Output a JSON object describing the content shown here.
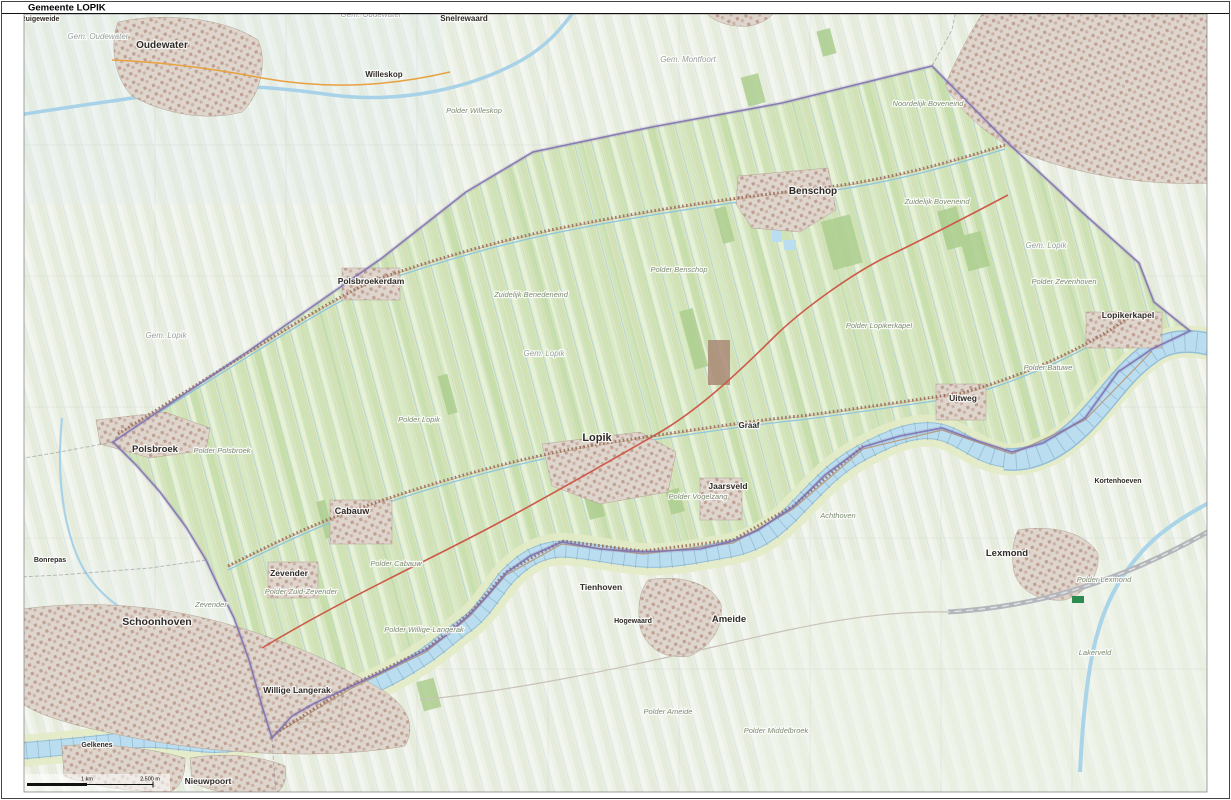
{
  "title": "Gemeente LOPIK",
  "scalebar": {
    "label_km": "1 km",
    "label_m": "2.500 m"
  },
  "colors": {
    "municipality_fill": "#dce9c8",
    "municipality_boundary": "#7b6cae",
    "water": "#badef0",
    "water_edge": "#94bed8",
    "urban": "#c9aca0",
    "main_road": "#cd5b4a",
    "outside_fill": "#eef1e7",
    "motorway": "#b3b6bb"
  },
  "map": {
    "labels": [
      {
        "id": "oudewater",
        "text": "Oudewater",
        "x": 162,
        "y": 48,
        "type": "town",
        "size": 10
      },
      {
        "id": "schoonhoven",
        "text": "Schoonhoven",
        "x": 157,
        "y": 625,
        "type": "town",
        "size": 10.5
      },
      {
        "id": "benschop",
        "text": "Benschop",
        "x": 813,
        "y": 194,
        "type": "town",
        "size": 10
      },
      {
        "id": "lopik",
        "text": "Lopik",
        "x": 597,
        "y": 441,
        "type": "town",
        "size": 11
      },
      {
        "id": "polsbroek",
        "text": "Polsbroek",
        "x": 155,
        "y": 452,
        "type": "town",
        "size": 9.5
      },
      {
        "id": "polsbroekerdam",
        "text": "Polsbroekerdam",
        "x": 371,
        "y": 284,
        "type": "town",
        "size": 8.5
      },
      {
        "id": "cabauw",
        "text": "Cabauw",
        "x": 352,
        "y": 514,
        "type": "town",
        "size": 9
      },
      {
        "id": "zevender",
        "text": "Zevender",
        "x": 289,
        "y": 576,
        "type": "town",
        "size": 8.5
      },
      {
        "id": "willige-langerak",
        "text": "Willige Langerak",
        "x": 297,
        "y": 693,
        "type": "town",
        "size": 8.5
      },
      {
        "id": "jaarsveld",
        "text": "Jaarsveld",
        "x": 728,
        "y": 489,
        "type": "town",
        "size": 8.5
      },
      {
        "id": "uitweg",
        "text": "Uitweg",
        "x": 963,
        "y": 401,
        "type": "town",
        "size": 8.5
      },
      {
        "id": "lopikerkapel",
        "text": "Lopikerkapel",
        "x": 1128,
        "y": 318,
        "type": "town",
        "size": 8.5
      },
      {
        "id": "graaf",
        "text": "Graaf",
        "x": 749,
        "y": 428,
        "type": "town",
        "size": 8
      },
      {
        "id": "ameide",
        "text": "Ameide",
        "x": 729,
        "y": 622,
        "type": "town",
        "size": 9.5
      },
      {
        "id": "tienhoven",
        "text": "Tienhoven",
        "x": 601,
        "y": 590,
        "type": "town",
        "size": 8.5
      },
      {
        "id": "lexmond",
        "text": "Lexmond",
        "x": 1007,
        "y": 556,
        "type": "town",
        "size": 9.5
      },
      {
        "id": "nieuwpoort",
        "text": "Nieuwpoort",
        "x": 208,
        "y": 784,
        "type": "town",
        "size": 8.5
      },
      {
        "id": "snelrewaard",
        "text": "Snelrewaard",
        "x": 464,
        "y": 21,
        "type": "town",
        "size": 8
      },
      {
        "id": "willeskop",
        "text": "Willeskop",
        "x": 384,
        "y": 77,
        "type": "town",
        "size": 8
      },
      {
        "id": "bonrepas",
        "text": "Bonrepas",
        "x": 50,
        "y": 562,
        "type": "town",
        "size": 7
      },
      {
        "id": "ruigeweide",
        "text": "Ruigeweide",
        "x": 40,
        "y": 21,
        "type": "town",
        "size": 7
      },
      {
        "id": "kortenhoeven",
        "text": "Kortenhoeven",
        "x": 1118,
        "y": 483,
        "type": "town",
        "size": 7
      },
      {
        "id": "hogewaard",
        "text": "Hogewaard",
        "x": 633,
        "y": 623,
        "type": "town",
        "size": 7
      },
      {
        "id": "gelkenes",
        "text": "Gelkenes",
        "x": 97,
        "y": 747,
        "type": "town",
        "size": 7
      },
      {
        "id": "zevender-area",
        "text": "Zevender",
        "x": 211,
        "y": 607,
        "type": "polder"
      },
      {
        "id": "p-polsbroek",
        "text": "Polder Polsbroek",
        "x": 222,
        "y": 453,
        "type": "polder"
      },
      {
        "id": "p-benschop",
        "text": "Polder Benschop",
        "x": 679,
        "y": 272,
        "type": "polder"
      },
      {
        "id": "p-lopikerkapel",
        "text": "Polder Lopikerkapel",
        "x": 879,
        "y": 328,
        "type": "polder"
      },
      {
        "id": "p-lopik",
        "text": "Polder Lopik",
        "x": 419,
        "y": 422,
        "type": "polder"
      },
      {
        "id": "p-cabauw",
        "text": "Polder Cabauw",
        "x": 396,
        "y": 566,
        "type": "polder"
      },
      {
        "id": "p-zuid-zevender",
        "text": "Polder Zuid-Zevender",
        "x": 301,
        "y": 594,
        "type": "polder"
      },
      {
        "id": "p-willige-langerak",
        "text": "Polder Willige-Langerak",
        "x": 424,
        "y": 632,
        "type": "polder"
      },
      {
        "id": "p-vogelzang",
        "text": "Polder Vogelzang",
        "x": 698,
        "y": 499,
        "type": "polder"
      },
      {
        "id": "p-batuwe",
        "text": "Polder Batuwe",
        "x": 1048,
        "y": 370,
        "type": "polder"
      },
      {
        "id": "p-zevenhoven",
        "text": "Polder Zevenhoven",
        "x": 1064,
        "y": 284,
        "type": "polder"
      },
      {
        "id": "zuidelijk-benedeneind",
        "text": "Zuidelijk Benedeneind",
        "x": 531,
        "y": 297,
        "type": "polder"
      },
      {
        "id": "noordelijk-boveneind",
        "text": "Noordelijk Boveneind",
        "x": 928,
        "y": 106,
        "type": "polder"
      },
      {
        "id": "zuidelijk-boveneind",
        "text": "Zuidelijk Boveneind",
        "x": 937,
        "y": 204,
        "type": "polder"
      },
      {
        "id": "p-willeskop",
        "text": "Polder Willeskop",
        "x": 474,
        "y": 113,
        "type": "polder"
      },
      {
        "id": "p-ameide",
        "text": "Polder Ameide",
        "x": 668,
        "y": 714,
        "type": "polder"
      },
      {
        "id": "p-middelbroek",
        "text": "Polder Middelbroek",
        "x": 776,
        "y": 733,
        "type": "polder"
      },
      {
        "id": "achthoven",
        "text": "Achthoven",
        "x": 838,
        "y": 518,
        "type": "polder"
      },
      {
        "id": "p-lexmond",
        "text": "Polder Lexmond",
        "x": 1104,
        "y": 582,
        "type": "polder"
      },
      {
        "id": "lakerveld",
        "text": "Lakerveld",
        "x": 1095,
        "y": 655,
        "type": "polder"
      },
      {
        "id": "gem-oudewater-1",
        "text": "Gem. Oudewater",
        "x": 98,
        "y": 39,
        "type": "gem"
      },
      {
        "id": "gem-oudewater-2",
        "text": "Gem. Oudewater",
        "x": 371,
        "y": 17,
        "type": "gem"
      },
      {
        "id": "gem-montfoort",
        "text": "Gem. Montfoort",
        "x": 688,
        "y": 62,
        "type": "gem"
      },
      {
        "id": "gem-lopik-1",
        "text": "Gem. Lopik",
        "x": 544,
        "y": 356,
        "type": "gem"
      },
      {
        "id": "gem-lopik-2",
        "text": "Gem. Lopik",
        "x": 1046,
        "y": 248,
        "type": "gem"
      },
      {
        "id": "gem-lopik-3",
        "text": "Gem. Lopik",
        "x": 166,
        "y": 338,
        "type": "gem"
      }
    ]
  }
}
